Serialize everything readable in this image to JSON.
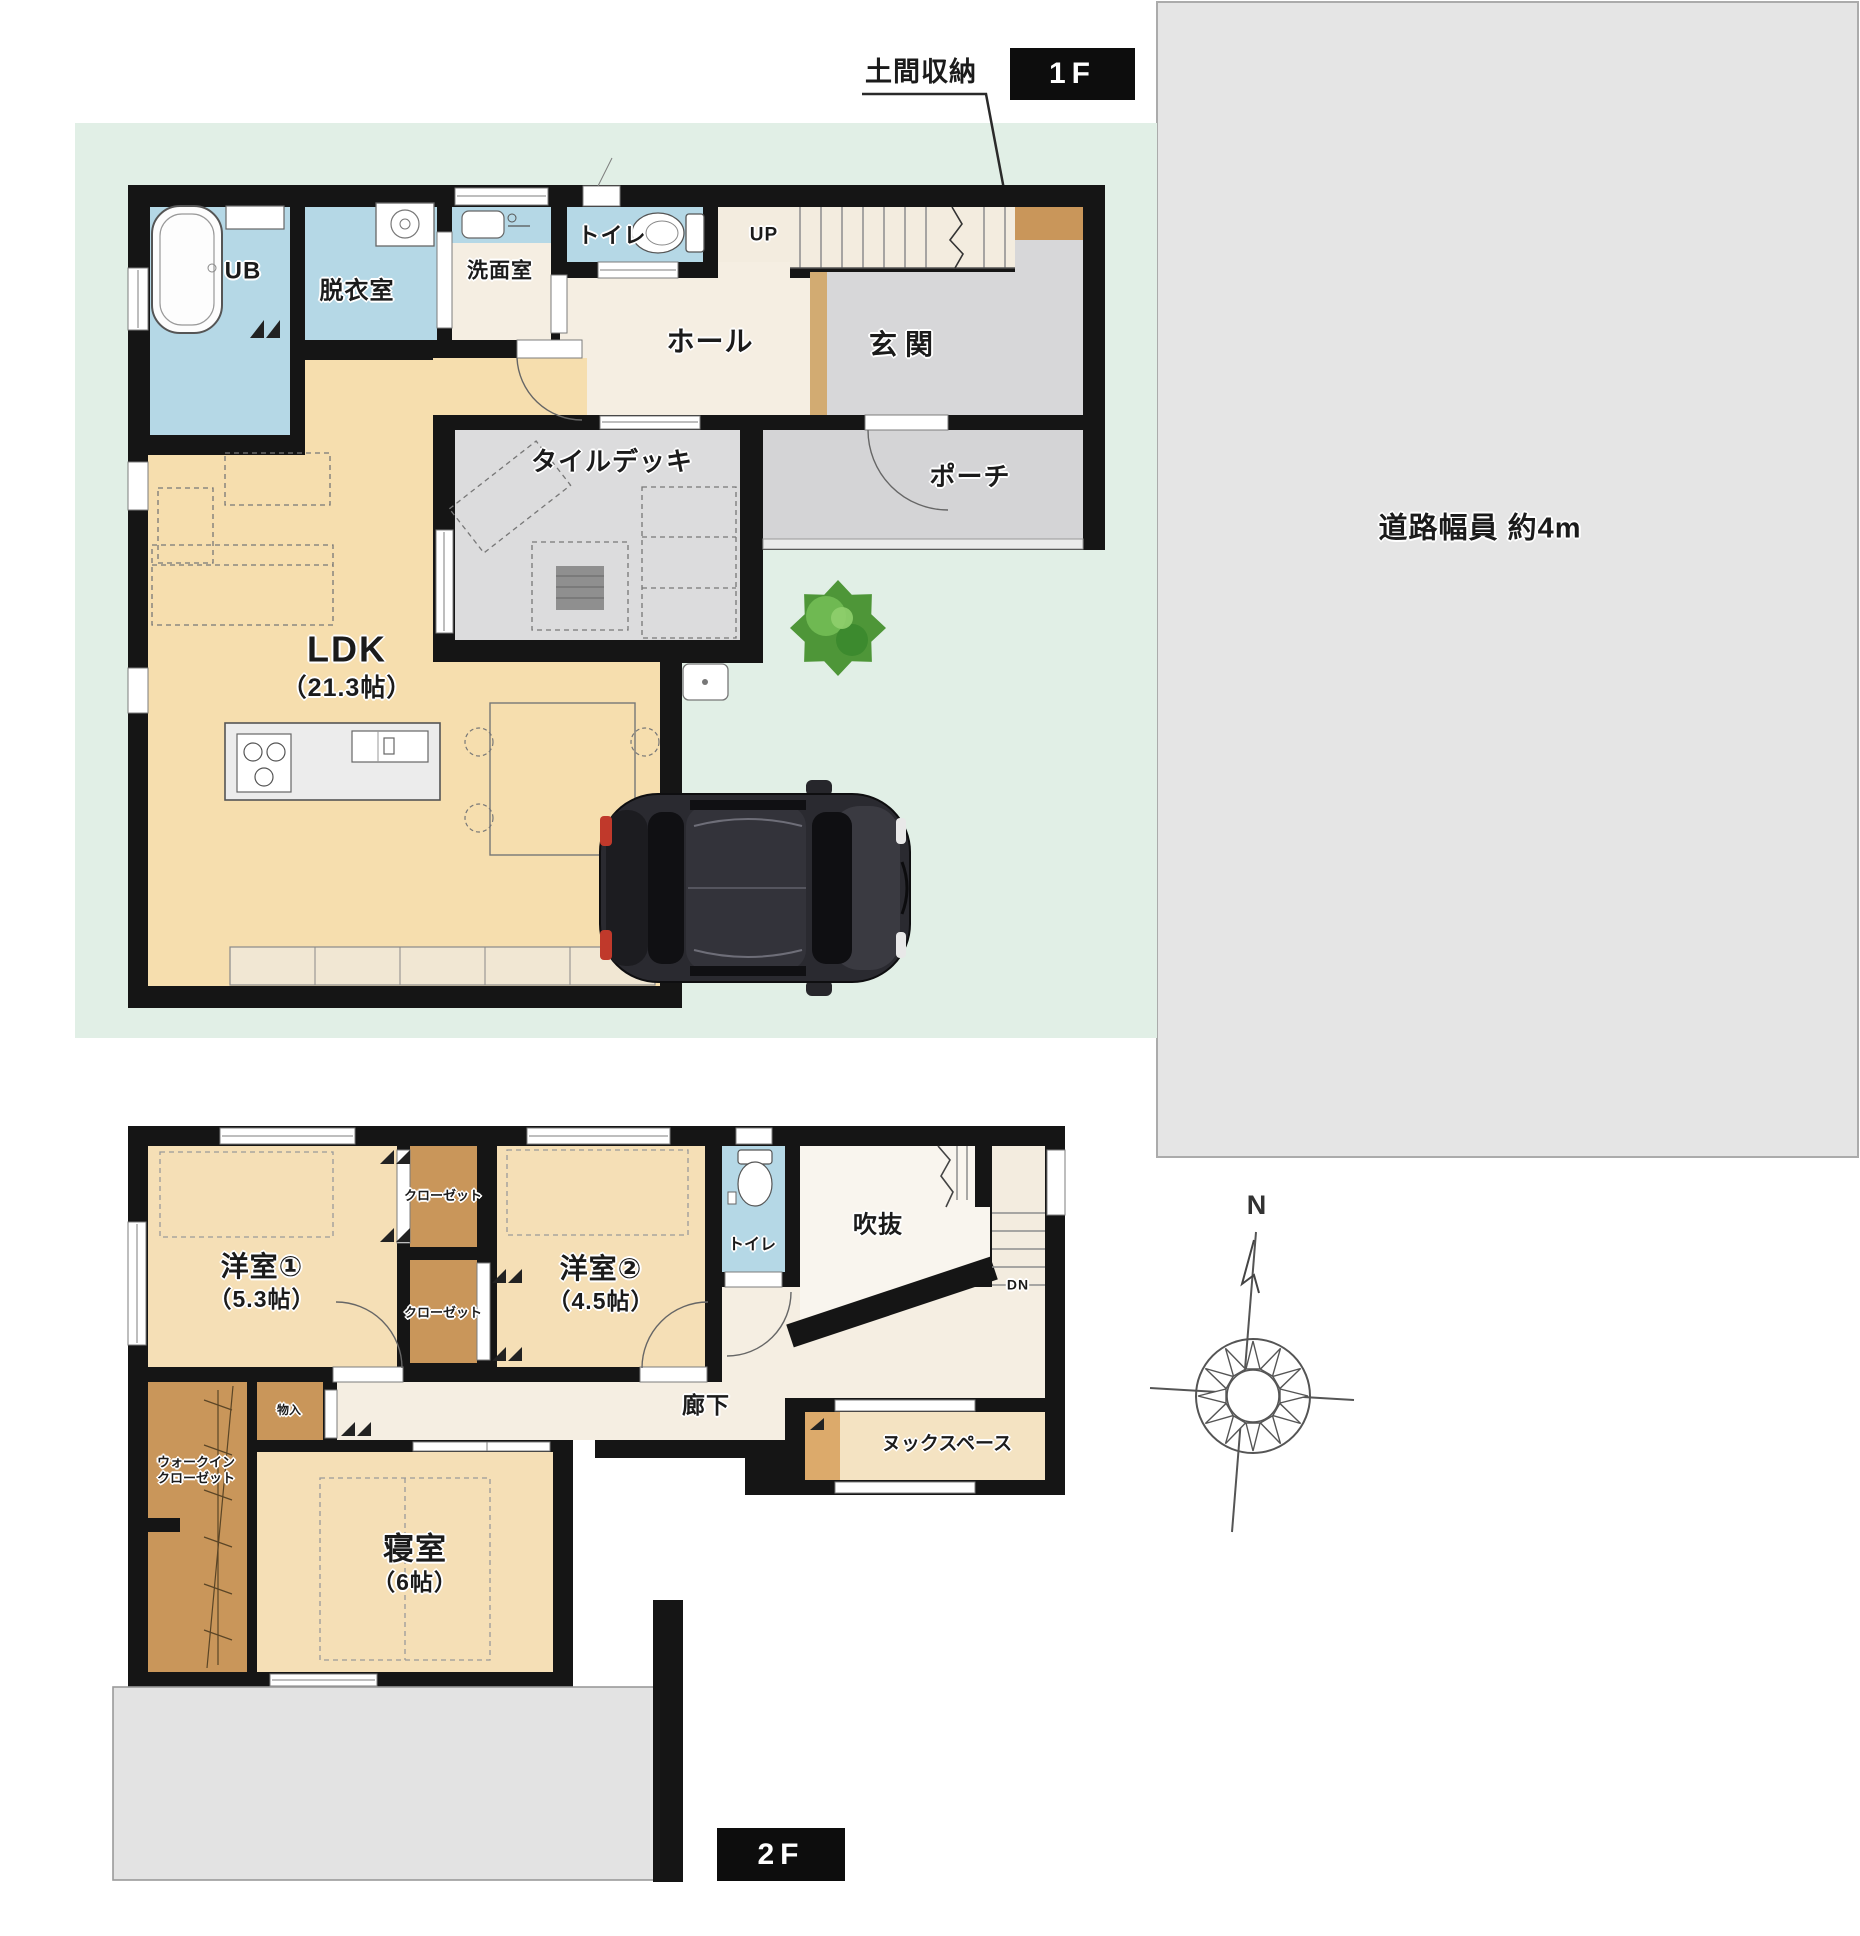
{
  "floor1": {
    "floor_label": "1F",
    "storage_callout": "土間収納",
    "road_label": "道路幅員 約4m",
    "rooms": {
      "unit_bath": "UB",
      "dressing_room": "脱衣室",
      "washroom": "洗面室",
      "toilet": "トイレ",
      "hall": "ホール",
      "entrance": "玄関",
      "stairs_up": "UP",
      "porch": "ポーチ",
      "tile_deck": "タイルデッキ",
      "ldk": "LDK",
      "ldk_size": "（21.3帖）"
    }
  },
  "floor2": {
    "floor_label": "2F",
    "compass_north": "N",
    "rooms": {
      "bedroom1": "洋室①",
      "bedroom1_size": "（5.3帖）",
      "bedroom2": "洋室②",
      "bedroom2_size": "（4.5帖）",
      "closet_upper": "クローゼット",
      "closet_lower": "クローゼット",
      "toilet": "トイレ",
      "void_space": "吹抜",
      "stairs_down": "DN",
      "hallway": "廊下",
      "storage": "物入",
      "nook": "ヌックスペース",
      "master_bedroom": "寝室",
      "master_bedroom_size": "（6帖）",
      "wic_line1": "ウォークイン",
      "wic_line2": "クローゼット"
    }
  },
  "colors": {
    "wall": "#151515",
    "site_green": "#e1efe6",
    "road_gray": "#e5e5e5",
    "room_blue": "#b5d8e6",
    "room_cream": "#f5eee2",
    "room_tan": "#f6deae",
    "room_gray": "#d7d7d9",
    "closet_brown": "#c9965a",
    "roof_gray": "#e3e3e3",
    "tree_green": "#4e9638",
    "car_body": "#2a2a30"
  }
}
